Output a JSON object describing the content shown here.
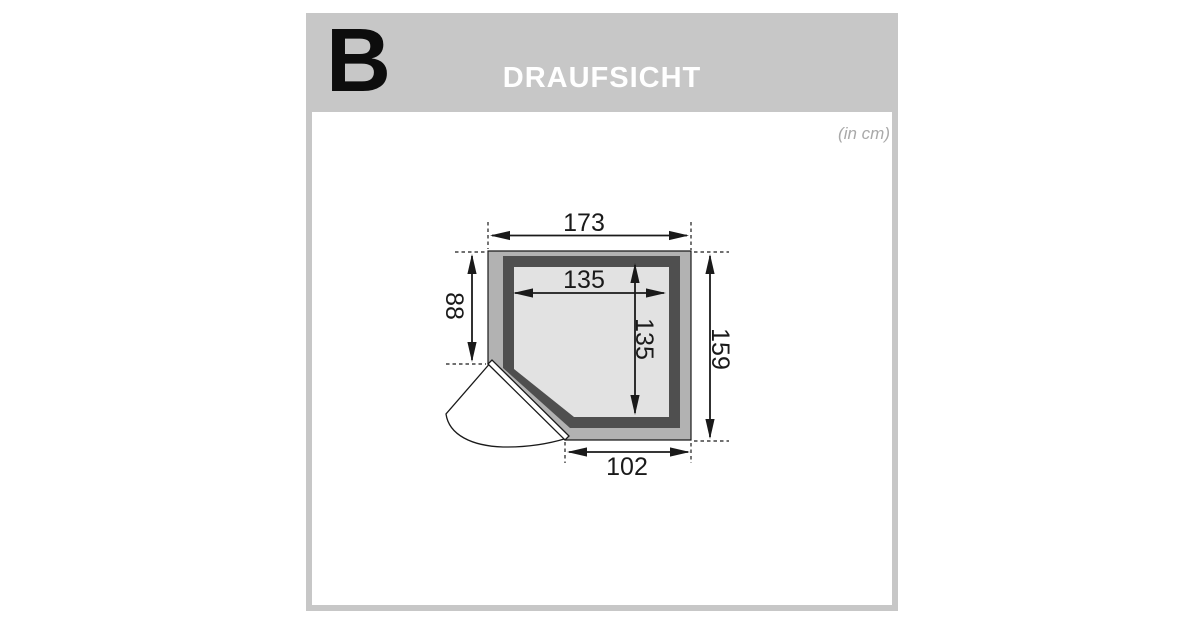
{
  "panel": {
    "section_label": "B",
    "title": "DRAUFSICHT",
    "units_note": "(in cm)"
  },
  "diagram": {
    "type": "floor-plan-top-view",
    "units": "cm",
    "labels": {
      "outer_width": "173",
      "inner_width": "135",
      "inner_depth": "135",
      "left_depth": "88",
      "outer_depth": "159",
      "door_side_width": "102"
    },
    "values": {
      "outer_width_cm": 173,
      "inner_width_cm": 135,
      "inner_depth_cm": 135,
      "left_depth_cm": 88,
      "outer_depth_cm": 159,
      "door_side_width_cm": 102
    },
    "features": [
      "square cabin footprint with clipped bottom-left corner",
      "double wall outline (outer band + dark lining)",
      "corner door with quarter swing arc at bottom-left"
    ]
  },
  "colors": {
    "header_gray": "#c7c7c7",
    "wall_outer_band": "#b2b2b2",
    "wall_dark_lining": "#4f4f4f",
    "floor_fill": "#e2e2e2",
    "line_color": "#1a1a1a",
    "units_text_gray": "#a9a9a9"
  }
}
